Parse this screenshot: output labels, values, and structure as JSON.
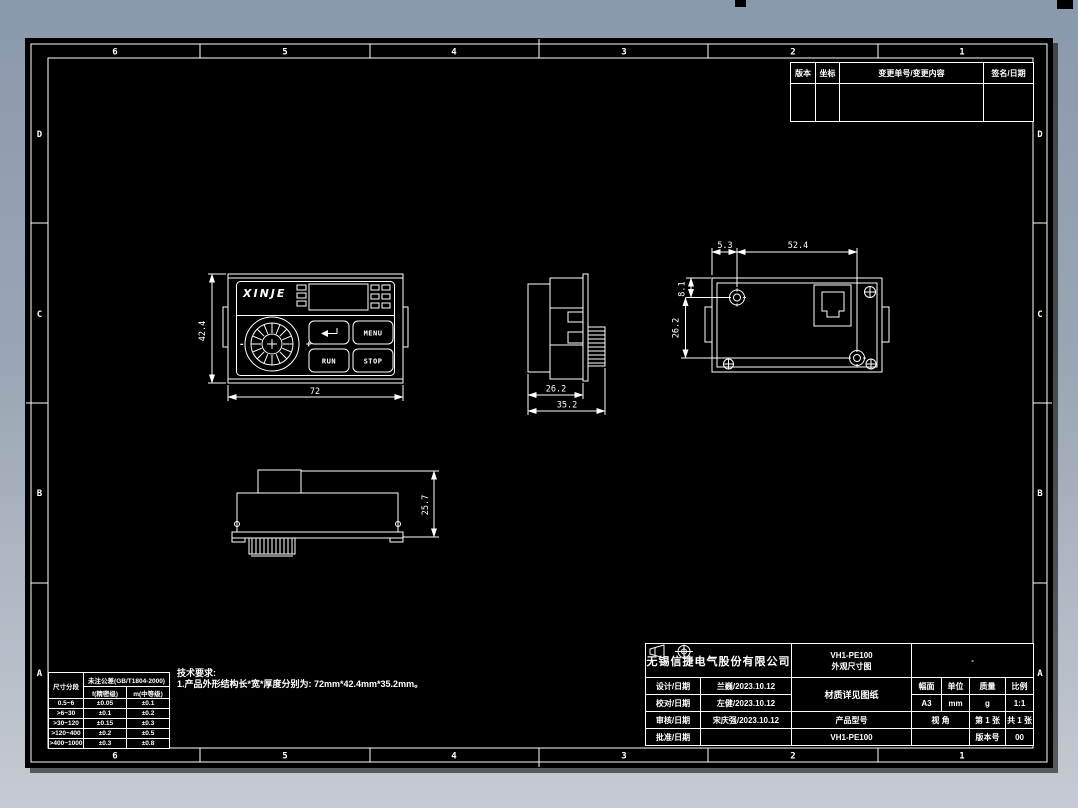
{
  "sheet": {
    "zone_columns": [
      "6",
      "5",
      "4",
      "3",
      "2",
      "1"
    ],
    "zone_rows": [
      "D",
      "C",
      "B",
      "A"
    ]
  },
  "revision_table": {
    "headers": [
      "版本",
      "坐标",
      "变更单号/变更内容",
      "签名/日期"
    ]
  },
  "views": {
    "front": {
      "logo": "XINJE",
      "buttons": {
        "menu": "MENU",
        "run": "RUN",
        "stop": "STOP"
      },
      "knob_min": "-",
      "knob_max": "+",
      "dim_height": "42.4",
      "dim_width": "72"
    },
    "side": {
      "dim_depth_body": "26.2",
      "dim_depth_total": "35.2"
    },
    "back": {
      "dim_edge_offset": "5.3",
      "dim_screw_span": "52.4",
      "dim_top_offset": "8.1",
      "dim_screw_vertical": "26.2"
    },
    "bottom": {
      "dim_height": "25.7"
    }
  },
  "tech_requirements": {
    "title": "技术要求:",
    "items": [
      "1.产品外形结构长*宽*厚度分别为: 72mm*42.4mm*35.2mm。"
    ]
  },
  "tolerance_table": {
    "col_header": "尺寸分段",
    "std_header": "未注公差(GB/T1804-2000)",
    "sub_headers": [
      "f(精密级)",
      "m(中等级)"
    ],
    "rows": [
      [
        "0.5~6",
        "±0.05",
        "±0.1"
      ],
      [
        ">6~30",
        "±0.1",
        "±0.2"
      ],
      [
        ">30~120",
        "±0.15",
        "±0.3"
      ],
      [
        ">120~400",
        "±0.2",
        "±0.5"
      ],
      [
        ">400~1000",
        "±0.3",
        "±0.8"
      ]
    ]
  },
  "title_block": {
    "company": "无锡信捷电气股份有限公司",
    "title_line1": "VH1-PE100",
    "title_line2": "外观尺寸图",
    "top_right": "-",
    "sign_rows": [
      {
        "label": "设计/日期",
        "value": "兰巍/2023.10.12"
      },
      {
        "label": "校对/日期",
        "value": "左健/2023.10.12"
      },
      {
        "label": "审核/日期",
        "value": "宋庆强/2023.10.12"
      },
      {
        "label": "批准/日期",
        "value": ""
      }
    ],
    "material_note": "材质详见图纸",
    "spec_headers": [
      "幅面",
      "单位",
      "质量",
      "比例"
    ],
    "spec_values": [
      "A3",
      "mm",
      "g",
      "1:1"
    ],
    "product_model_label": "产品型号",
    "product_model": "VH1-PE100",
    "view_angle_label": "视  角",
    "sheet_number": "第 1 张",
    "sheet_total": "共 1 张",
    "version_label": "版本号",
    "version": "00"
  }
}
